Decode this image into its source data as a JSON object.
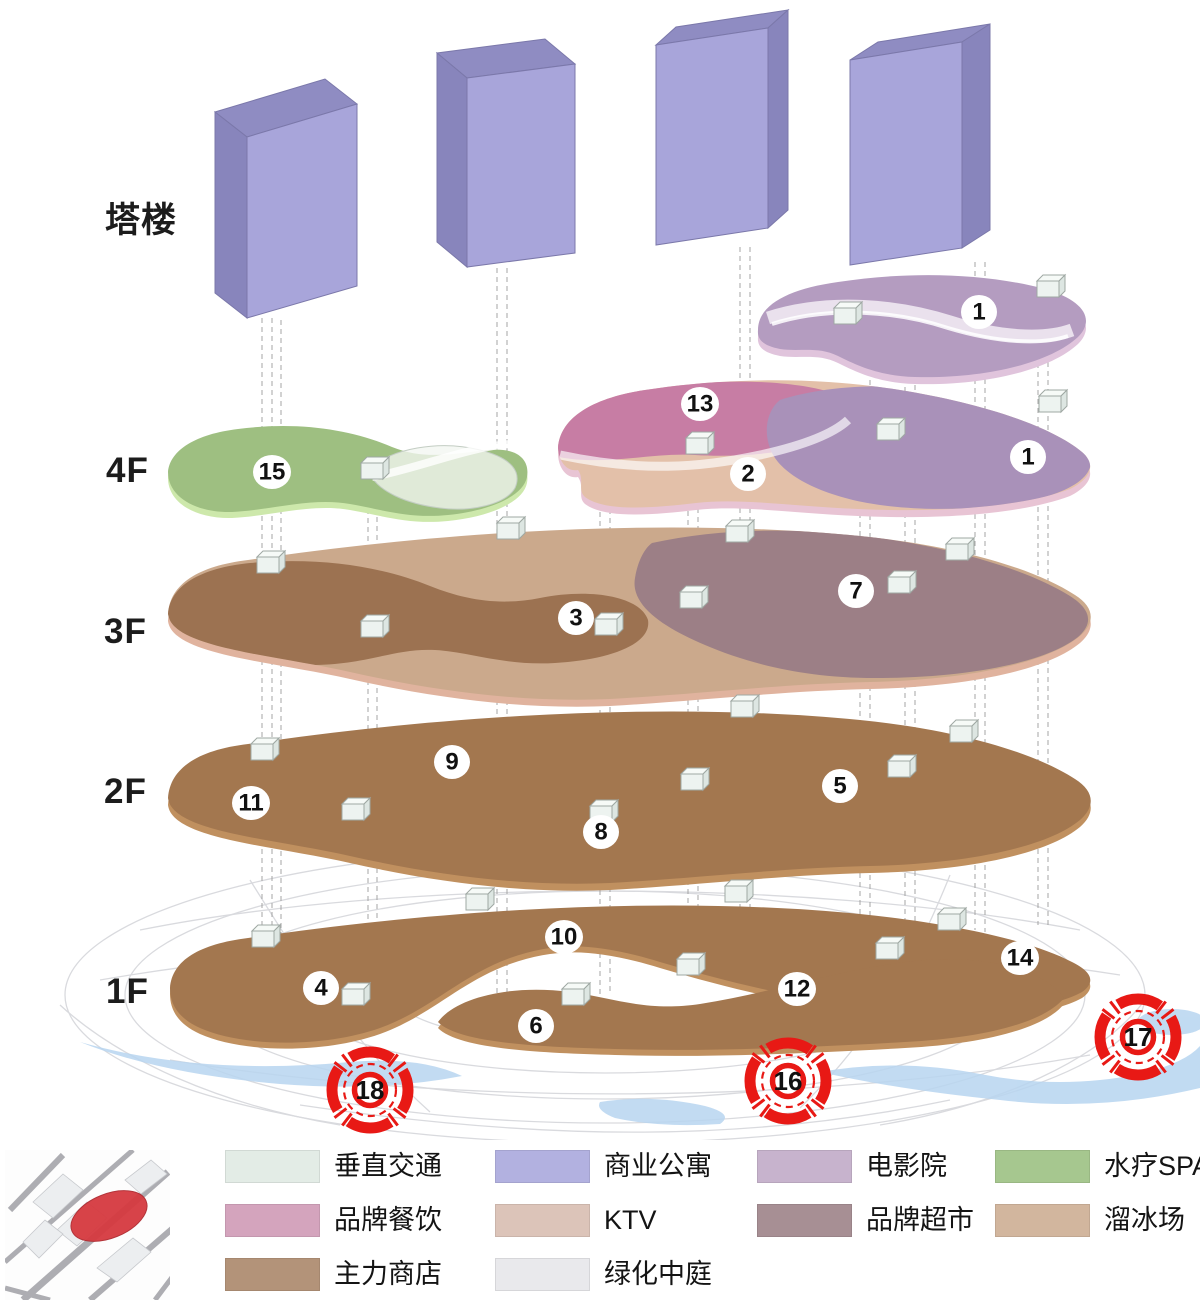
{
  "diagram": {
    "floor_labels": [
      "塔楼",
      "4F",
      "3F",
      "2F",
      "1F"
    ],
    "badges": [
      "1",
      "13",
      "2",
      "1",
      "15",
      "3",
      "7",
      "9",
      "11",
      "8",
      "5",
      "10",
      "4",
      "14",
      "12",
      "6"
    ],
    "markers": [
      "18",
      "16",
      "17"
    ],
    "colors": {
      "tower_face": "#a8a5da",
      "tower_top": "#8f8cc2",
      "tower_side": "#8885bc",
      "tower_line": "#7b78aa",
      "plate_brown": "#a3774f",
      "plate_brown_rim": "#c0905f",
      "plate_tan": "#cba98c",
      "plate_tan_rim": "#e0b39e",
      "blob_brown": "#9c7251",
      "blob_mauve": "#9c7f86",
      "plate_ktv": "#e3c0a9",
      "plate_pink": "#c77da4",
      "plate_purple": "#a991b9",
      "plate_purple_rim": "#e8c4d4",
      "top_plate": "#b49cc0",
      "top_plate_rim": "#e0c4dc",
      "plate_green": "#9ebf81",
      "plate_green_rim": "#cde8ab",
      "marker_red": "#e81915",
      "water": "#b7d5f0",
      "ground_line": "#d9dade",
      "dash_line": "#a0a0a0",
      "badge_bg": "#ffffff",
      "badge_text": "#111111"
    }
  },
  "legend": {
    "items": [
      {
        "label": "垂直交通",
        "color": "#e3ece6"
      },
      {
        "label": "品牌餐饮",
        "color": "#d4a4bd"
      },
      {
        "label": "主力商店",
        "color": "#b39379"
      },
      {
        "label": "商业公寓",
        "color": "#b2b1e0"
      },
      {
        "label": "KTV",
        "color": "#dcc4b9"
      },
      {
        "label": "绿化中庭",
        "color": "#e9e9ec"
      },
      {
        "label": "电影院",
        "color": "#c7b3cd"
      },
      {
        "label": "品牌超市",
        "color": "#a78f94"
      },
      {
        "label": "水疗SPA",
        "color": "#a6c78f"
      },
      {
        "label": "溜冰场",
        "color": "#d2b69e"
      }
    ]
  },
  "site_map": {
    "highlight_color": "#d63a40"
  }
}
